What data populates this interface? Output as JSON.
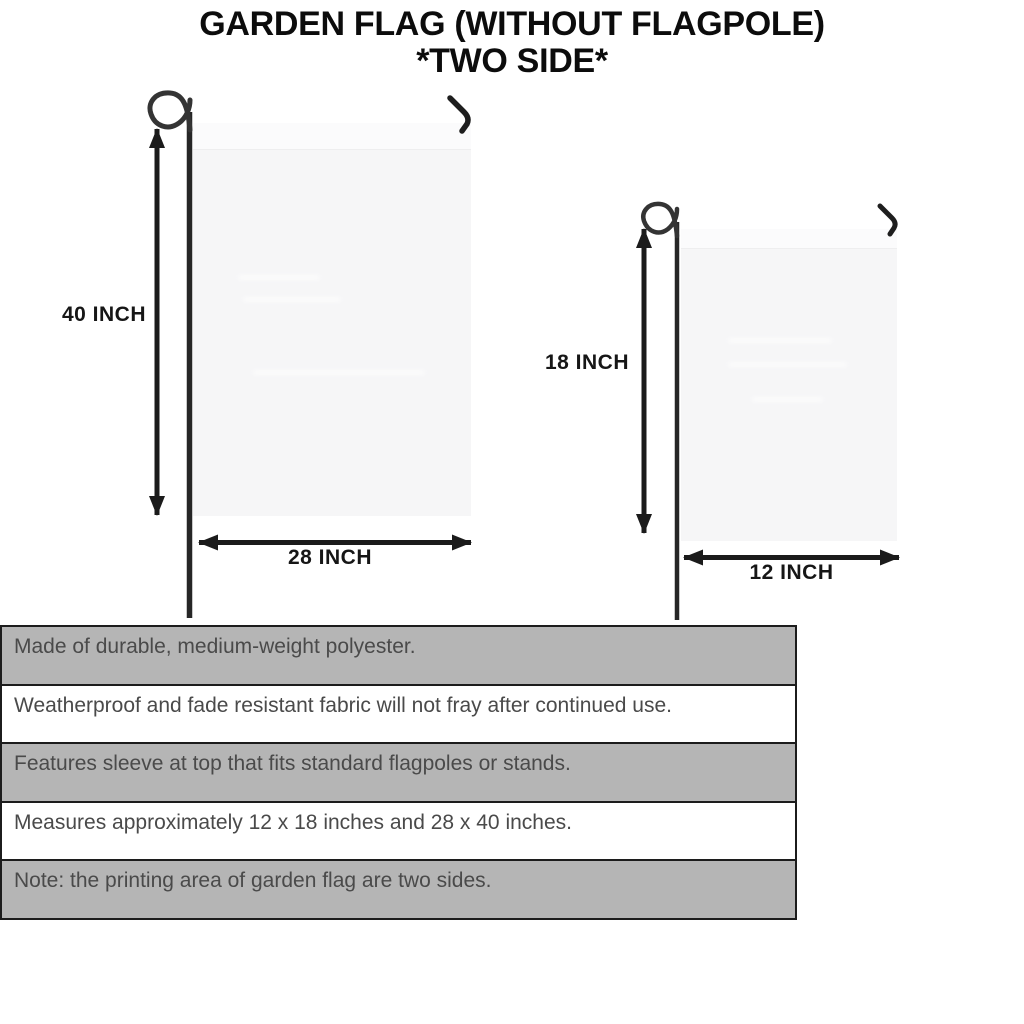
{
  "title": {
    "line1": "GARDEN FLAG (WITHOUT FLAGPOLE)",
    "line2": "*TWO SIDE*"
  },
  "flags": {
    "large": {
      "height_label": "40 INCH",
      "width_label": "28 INCH"
    },
    "small": {
      "height_label": "18 INCH",
      "width_label": "12 INCH"
    }
  },
  "specs": {
    "rows": [
      "Made of durable, medium-weight polyester.",
      "Weatherproof and fade resistant fabric will not fray after continued use.",
      "Features sleeve at top that fits standard flagpoles or stands.",
      "Measures approximately 12 x 18 inches and 28 x 40 inches.",
      "Note: the printing area of garden flag are two sides."
    ]
  },
  "colors": {
    "row_gray": "#b5b5b5",
    "row_white": "#ffffff",
    "table_border": "#1c1c1c",
    "spec_text": "#4a4a4a",
    "flag_fill": "#f6f6f7",
    "flag_sleeve": "#fbfbfc",
    "pole": "#262626",
    "arrow": "#1b1b1b",
    "title_text": "#0c0c0c"
  }
}
